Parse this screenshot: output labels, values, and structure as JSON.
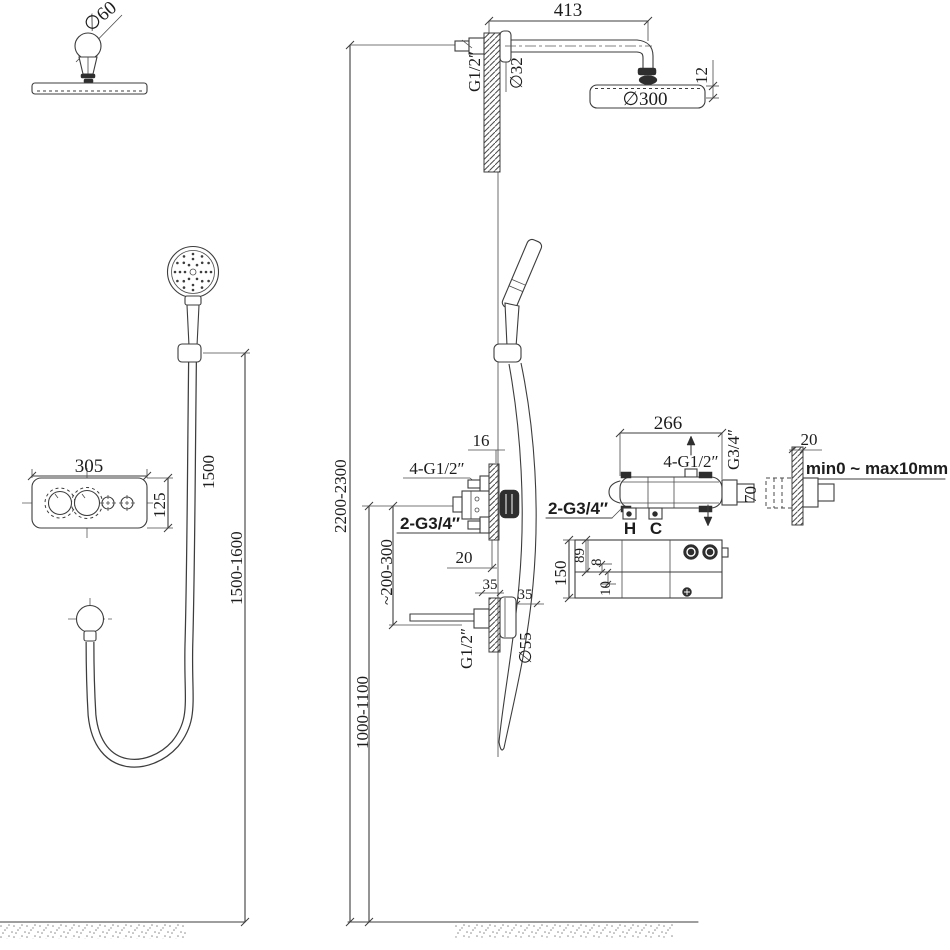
{
  "figures": {
    "top_detail": {
      "knob_dia": "∅60"
    },
    "shower_arm": {
      "length": "413",
      "wall_thread": "G1/2″",
      "arm_dia": "∅32",
      "head_dia": "∅300",
      "head_edge": "12"
    },
    "hand_shower": {
      "hose_len": "1500",
      "holder_height": "1500-1600"
    },
    "control_panel": {
      "width": "305",
      "height": "125"
    },
    "column": {
      "overall_height": "2200-2300",
      "inlet_height": "1000-1100",
      "outlet_drop": "~200-300",
      "wall_gap": "16",
      "top_ports": "4-G1/2″",
      "inlet_ports": "2-G3/4″",
      "trim_gap": "20",
      "offset_a": "35",
      "offset_b": "35",
      "outlet_thread": "G1/2″",
      "escutcheon_dia": "∅55"
    },
    "valve_top": {
      "width": "266",
      "top_ports": "4-G1/2″",
      "side_thread": "G3/4″",
      "depth": "70",
      "inlet_ports": "2-G3/4″",
      "hot": "H",
      "cold": "C"
    },
    "valve_front": {
      "height": "150",
      "dim_a": "89",
      "dim_b": "8",
      "dim_c": "10"
    },
    "wall_detail": {
      "wall_thickness": "20",
      "adjust_range": "min0 ~ max10mm"
    }
  }
}
